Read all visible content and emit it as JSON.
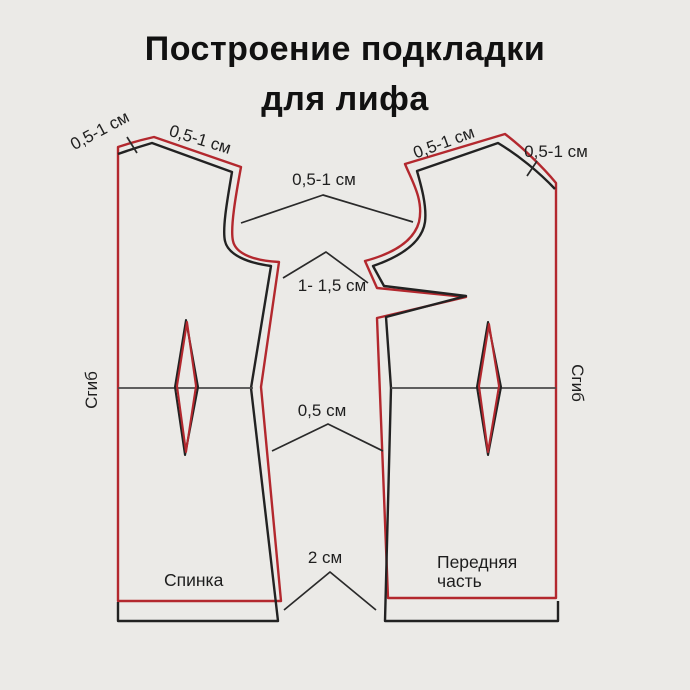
{
  "title": {
    "line1": "Построение подкладки",
    "line2": "для лифа"
  },
  "annotations": {
    "back_neck": "0,5-1 см",
    "back_shoulder": "0,5-1 см",
    "front_shoulder": "0,5-1 см",
    "front_neck": "0,5-1 см",
    "armhole": "0,5-1 см",
    "armhole_depth": "1- 1,5 см",
    "side_seam": "0,5 см",
    "hem": "2 см",
    "fold_left": "Сгиб",
    "fold_right": "Сгиб"
  },
  "pieces": {
    "back": "Спинка",
    "front": "Передняя часть"
  },
  "colors": {
    "background": "#ebeae7",
    "pattern": "#222222",
    "lining": "#b3282e",
    "annotation": "#2a2a2a"
  }
}
